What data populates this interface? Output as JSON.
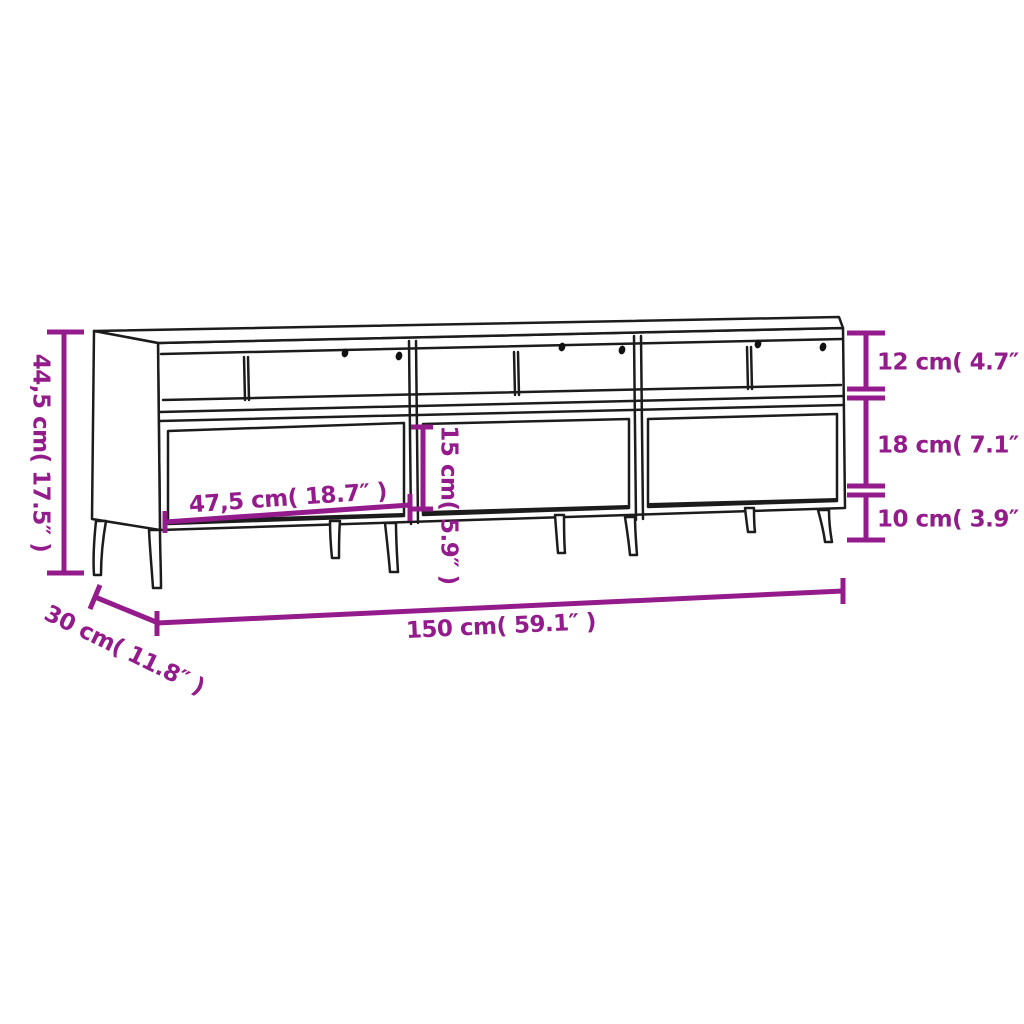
{
  "diagram": {
    "background": "#ffffff",
    "outline_color": "#1c1c1c",
    "dimension_color": "#941b8b",
    "labels": {
      "overall_height": "44,5 cm( 17.5″ )",
      "compartment_height": "12 cm( 4.7″ )",
      "drawer_height": "18 cm( 7.1″ )",
      "leg_height": "10 cm( 3.9″ )",
      "drawer_width": "47,5 cm( 18.7″ )",
      "drawer_front_height": "15 cm( 5.9″ )",
      "overall_width": "150 cm( 59.1″ )",
      "overall_depth": "30 cm( 11.8″ )"
    }
  }
}
